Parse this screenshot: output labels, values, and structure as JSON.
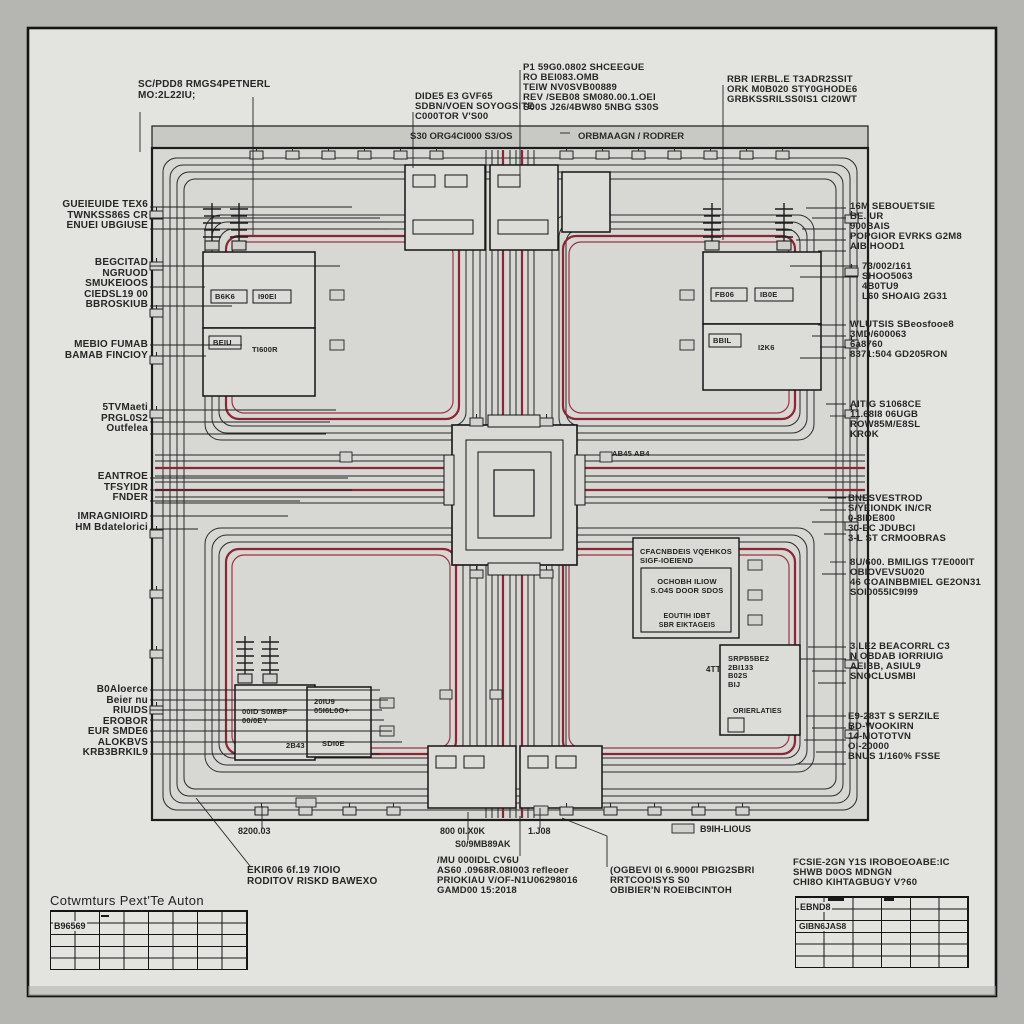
{
  "colors": {
    "page_margin": "#b5b5b2",
    "sheet": "#e3e3e0",
    "frame_fill": "#d7d7d4",
    "line": "#1c1c1c",
    "trace_red": "#8e2532",
    "block_fill": "#dcdcd9"
  },
  "labels": {
    "top_left": [
      "SC/PDD8 RMGS4PETNERL",
      "MO:2L22IU;"
    ],
    "top_center_a": [
      "DIDE5 E3 GVF65",
      "SDBN/VOEN SOYOGSITE",
      "C000TOR V'S00"
    ],
    "band_left": "S30 ORG4CI000 S3/OS",
    "top_center_b": [
      "P1 59G0.0802 SHCEEGUE",
      "RO BEI083.OMB",
      "TEIW NV0SVB00889",
      "REV /SEB08 SM080.00.1.OEI",
      "S00S J26/4BW80 5NBG S30S"
    ],
    "band_right": "ORBMAAGN / RODRER",
    "top_right": [
      "RBR IERBL.E T3ADR2SSIT",
      "ORK M0B020 STY0GHODE6",
      "GRBKSSRILSS0IS1 CI20WT"
    ],
    "left": [
      [
        "GUEIEUIDE TEX6",
        "TWNKSS86S CR",
        "ENUEI UBGIUSE"
      ],
      [
        "BEGCITAD",
        "NGRUOD",
        "SMUKEIOOS",
        "CIEDSL19 00",
        "BBROSKIUB"
      ],
      [
        "MEBIO FUMAB",
        "BAMAB FINCIOY"
      ],
      [
        "5TVMaeti",
        "PRGL0S2",
        "Outfelea"
      ],
      [
        "EANTROE",
        "TFSYIDR",
        "FNDER"
      ],
      [
        "IMRAGNIOIRD",
        "HM Bdatelorici"
      ],
      [
        "B0Aloerce",
        "Beier nu",
        "RIUIDS",
        "EROBOR",
        "EUR SMDE6",
        "ALOKBVS",
        "KRB3BRKIL9"
      ]
    ],
    "right": [
      [
        "16M SEBOUETSIE",
        "BE.IUR",
        "900BAIS",
        "POPGIOR EVRKS G2M8",
        "AIBIHOOD1"
      ],
      [
        "73/002/161",
        "SHOO5063",
        "4B0TU9",
        "L60 SHOAIG 2G31"
      ],
      [
        "WLUTSIS SBeosfooe8",
        "3MD/600063",
        "6a8760",
        "8371:504 GD205RON"
      ],
      [
        "AITIG S1068CE",
        "11.68I8 06UGB",
        "ROW85M/E8SL",
        "KROK"
      ],
      [
        "BNESVESTROD",
        "S/YEIONDK IN/CR",
        "0-8IDE800",
        "30-EC JDUBCI",
        "3-L ST CRMOOBRAS"
      ],
      [
        "8U/600. BMILIGS T7E000IT",
        "OBIOVEVSU020",
        "46 COAINBBMIEL GE2ON31",
        "SOI0055IC9I99"
      ],
      [
        "3.LE2 BEACORRL C3",
        "N OBDAB IORRIUIG",
        "AEIBB, ASIUL9",
        "SNOCLUSMBI"
      ],
      [
        "E9-283T S SERZILE",
        "BD-WOOKIRN",
        "14-MOTOTVN",
        "OI-20000",
        "BNUS 1/160% FSSE"
      ]
    ],
    "bottom_small": {
      "b1": "8200.03",
      "b2": "800 0I.X0K",
      "b3": "S0/9MB89AK",
      "b4": "1.J08",
      "b5": "B9IH-LIOUS"
    },
    "bottom_blocks": [
      [
        "EKIR06 6f.19 7IOIO",
        "RODITOV RISKD BAWEXO"
      ],
      [
        "/MU 000IDL CV6U",
        "AS60 .0968R.08I003 refleoer",
        "PRIOKIAU V/OF-N1U06298016",
        "GAMD00 15:2018"
      ],
      [
        "(OGBEVI 0I 6.9000I PBIG2SBRI",
        "RRTCOOISYS S0",
        "OBIBIER'N ROEIBCINTOH"
      ],
      [
        "FCSIE-2GN Y1S IROBOEOABE:IC",
        "SHWB D0OS MDNGN",
        "CHI8O KIHTAGBUGY V?60"
      ]
    ]
  },
  "blocks": {
    "ul": {
      "a1": "B6K6",
      "a2": "I90EI",
      "b1": "BEIU",
      "b2": "TI600R"
    },
    "ur": {
      "a1": "FB06",
      "a2": "IB0E",
      "b1": "BBIL",
      "b2": "I2K6"
    },
    "center_note": "AB45 AB4",
    "info": {
      "header": [
        "CFACNBDEIS VQEHKOS",
        "SIGF-IOEIEND"
      ],
      "body": [
        "OCHOBH ILIOW",
        "S.O4S DOOR SDOS"
      ],
      "footer": [
        "EOUTIH IDBT",
        "SBR EIKTAGEIS"
      ]
    },
    "ll": {
      "a": [
        "00ID S0MBF",
        "00/0EY"
      ],
      "b": [
        "20IU9",
        "05I6L0O+"
      ],
      "b_sub": "SDI0E",
      "mid": "2B43"
    },
    "lr": {
      "head": [
        "SRPB5BE2",
        "2BI133",
        "B02S",
        "BIJ"
      ],
      "label": "ORIERLATIES",
      "side": "4TT"
    }
  },
  "tables": {
    "left": {
      "title": "Cotwmturs Pext'Te Auton",
      "cell": "B96569"
    },
    "right": {
      "cell1": "EBND8",
      "cell2": "GIBN6JAS8"
    }
  }
}
